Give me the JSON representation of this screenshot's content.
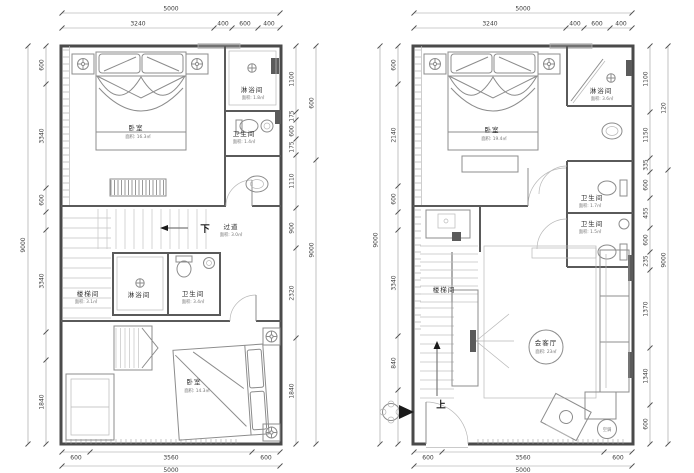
{
  "left": {
    "top_total": "5000",
    "top_dims": [
      "3240",
      "400",
      "600",
      "400"
    ],
    "left_total": "9000",
    "left_dims": [
      "600",
      "3340",
      "600",
      "3340",
      "1840"
    ],
    "right_dims": [
      "1100",
      "175",
      "600",
      "175",
      "1110",
      "900",
      "2320",
      "1840"
    ],
    "right_outer_top": "600",
    "right_outer_total": "9000",
    "bottom_dims": [
      "600",
      "3560",
      "600"
    ],
    "bottom_total": "5000",
    "rooms": {
      "bedroom_top": {
        "name": "卧室",
        "area": "面积: 16.3㎡"
      },
      "shower_top": {
        "name": "淋浴间",
        "area": "面积: 1.8㎡"
      },
      "bath_top": {
        "name": "卫生间",
        "area": "面积: 1.4㎡"
      },
      "down_label": "下",
      "corridor": {
        "name": "过道",
        "area": "面积: 3.0㎡"
      },
      "stair": {
        "name": "楼梯间",
        "area": "面积: 3.1㎡"
      },
      "shower_mid": {
        "name": "淋浴间"
      },
      "bath_mid": {
        "name": "卫生间",
        "area": "面积: 3.4㎡"
      },
      "bedroom_bottom": {
        "name": "卧室",
        "area": "面积: 14.3㎡"
      }
    }
  },
  "right": {
    "top_total": "5000",
    "top_dims": [
      "3240",
      "400",
      "600",
      "400"
    ],
    "left_total": "9000",
    "left_dims": [
      "600",
      "2140",
      "600",
      "3340",
      "840"
    ],
    "right_dims": [
      "1100",
      "1150",
      "335",
      "600",
      "455",
      "600",
      "235",
      "1370",
      "1340",
      "600"
    ],
    "right_outer_top": "120",
    "right_outer_total": "9000",
    "bottom_dims": [
      "600",
      "3560",
      "600"
    ],
    "bottom_total": "5000",
    "rooms": {
      "bedroom": {
        "name": "卧室",
        "area": "面积: 19.4㎡"
      },
      "shower": {
        "name": "淋浴间",
        "area": "面积: 3.6㎡"
      },
      "bath_upper": {
        "name": "卫生间",
        "area": "面积: 1.7㎡"
      },
      "bath_lower": {
        "name": "卫生间",
        "area": "面积: 1.5㎡"
      },
      "stair": {
        "name": "楼梯间"
      },
      "living": {
        "name": "会客厅",
        "area": "面积: 23㎡"
      },
      "up_label": "上",
      "ac_label": "空调"
    }
  }
}
